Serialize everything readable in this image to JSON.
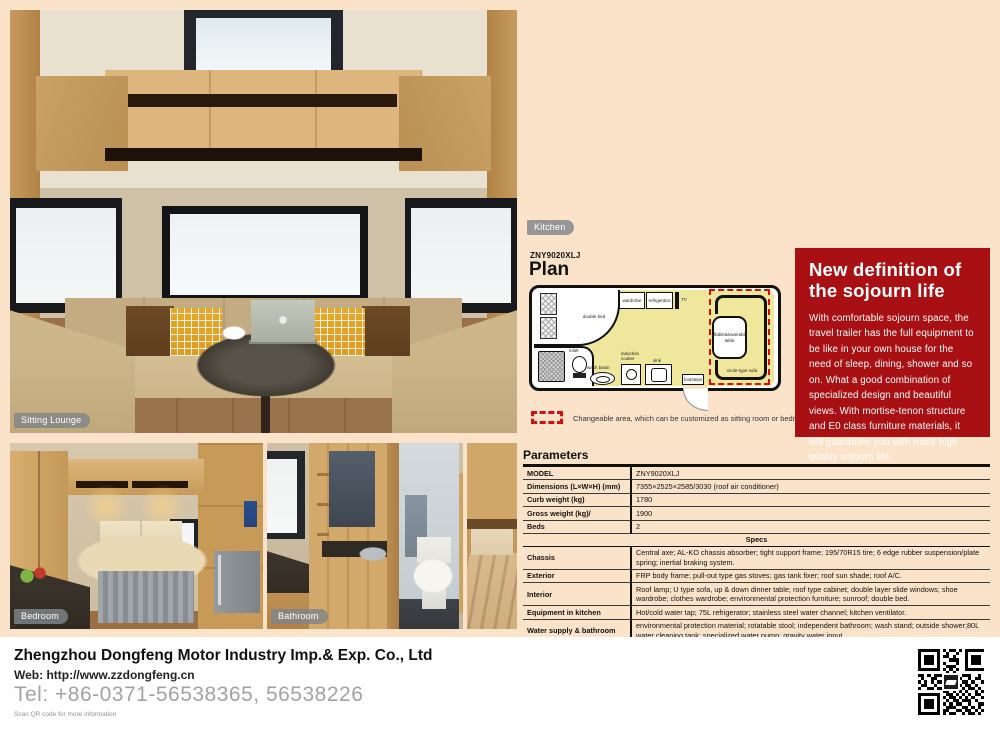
{
  "photos": {
    "sitting_lounge_label": "Sitting Lounge",
    "kitchen_label": "Kitchen",
    "bedroom_label": "Bedroom",
    "bathroom_label": "Bathroom"
  },
  "plan": {
    "model": "ZNY9020XLJ",
    "title": "Plan",
    "labels": {
      "double_bed": "double bed",
      "wardrobe": "wardrobe",
      "refrigerator": "refrigerator",
      "tv": "TV",
      "liftable_table": "liftable&lowerable table",
      "circle_sofa": "circle-type sofa",
      "toilet": "toilet",
      "wash_basin": "wash basin",
      "induction_cooker": "induction cooker",
      "sink": "sink",
      "footsteps": "footsteps"
    },
    "legend": "Changeable area, which can be customized as sitting room or bedroom."
  },
  "promo": {
    "accent_red": "#a81013",
    "title_line1": "New definition of",
    "title_line2": "the sojourn life",
    "body": "With comfortable sojourn space, the travel trailer has the full equipment to be like in your own house for the need of sleep, dining, shower and so on. What a good combination of specialized design and beautiful views. With mortise-tenon structure and E0 class furniture materials, it will guarantee you with more high quality sojourn life."
  },
  "parameters": {
    "heading": "Parameters",
    "rows": [
      {
        "label": "MODEL",
        "value": "ZNY9020XLJ"
      },
      {
        "label": "Dimensions (L×W×H)  (mm)",
        "value": "7355×2525×2585/3030 (roof air conditioner)"
      },
      {
        "label": "Curb weight (kg)",
        "value": "1780"
      },
      {
        "label": "Gross weight (kg)/",
        "value": "1900"
      },
      {
        "label": "Beds",
        "value": "2"
      }
    ],
    "specs_header": "Specs",
    "specs": [
      {
        "label": "Chassis",
        "value": "Central axe; AL-KO chassis absorber; tight support frame; 195/70R15 tire; 6 edge rubber suspension/plate spring; inertial braking system."
      },
      {
        "label": "Exterior",
        "value": "FRP body frame; pull-out type gas stoves; gas tank fixer; roof sun shade; roof A/C."
      },
      {
        "label": "Interior",
        "value": "Roof lamp; U type sofa, up & down dinner table; roof type cabinet; double layer slide windows; shoe wardrobe; clothes wardrobe; environmental protection furniture; sunroof; double bed."
      },
      {
        "label": "Equipment in kitchen",
        "value": "Hot/cold water tap; 75L refrigerator; stainless steel water channel; kitchen ventilator."
      },
      {
        "label": "Water supply & bathroom",
        "value": "environmental protection material; rotatable stool; independent bathroom; wash stand; outside shower;80L water cleaning tank; specialized water pump; gravity water input."
      },
      {
        "label": "Electrics",
        "value": "Electricity connector; 12V cable; 220V charger; touch type control board; DVD system; 19 inch LCD TV."
      }
    ]
  },
  "footer": {
    "company": "Zhengzhou Dongfeng Motor Industry Imp.& Exp. Co., Ltd",
    "web": "Web: http://www.zzdongfeng.cn",
    "tel": "Tel: +86-0371-56538365, 56538226",
    "qr_note": "Scan QR code for more information",
    "qr_pattern": [
      "1111111010110101111111",
      "1000001001001001000001",
      "1011101011010001011101",
      "1011101000111001011101",
      "1011101010001001011101",
      "1000001001110001000001",
      "1111111010101001111111",
      "000000000101000000000",
      "110101111001101110010",
      "010011000110110010110",
      "101010111101001101001",
      "011001001011110110100",
      "100110110100101011010",
      "000000001101010100101",
      "111111100110101010110",
      "100000101011010101001",
      "101110100101101110100",
      "101110101010110010011",
      "101110100111001101010",
      "100000101100110110101",
      "111111101011001011010"
    ]
  }
}
